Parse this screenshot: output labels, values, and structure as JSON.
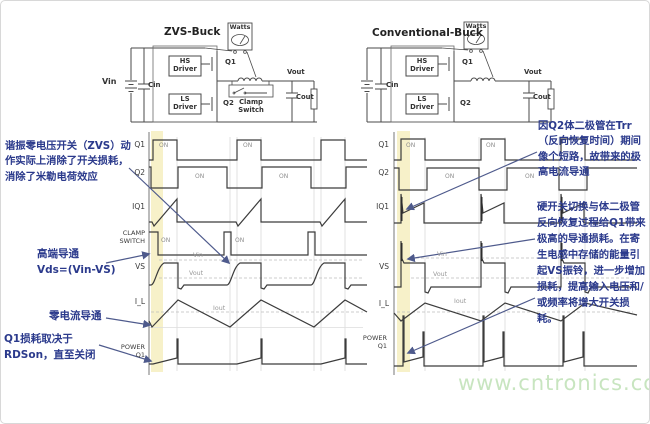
{
  "left_circuit": {
    "title": "ZVS-Buck",
    "watts_label": "Watts",
    "vin_label": "Vin",
    "cin_label": "Cin",
    "hs_driver": "HS\nDriver",
    "ls_driver": "LS\nDriver",
    "q1_label": "Q1",
    "q2_label": "Q2",
    "clamp_label": "Clamp\nSwitch",
    "vout_label": "Vout",
    "cout_label": "Cout"
  },
  "right_circuit": {
    "title": "Conventional-Buck",
    "watts_label": "Watts",
    "cin_label": "Cin",
    "hs_driver": "HS\nDriver",
    "ls_driver": "LS\nDriver",
    "q1_label": "Q1",
    "q2_label": "Q2",
    "vout_label": "Vout",
    "cout_label": "Cout"
  },
  "left_waveforms": {
    "row_labels": {
      "q1": "Q1",
      "q2": "Q2",
      "iq1": "IQ1",
      "clamp": "CLAMP\nSWITCH",
      "vs": "VS",
      "il": "I_L",
      "power": "POWER\nQ1"
    }
  },
  "right_waveforms": {
    "row_labels": {
      "q1": "Q1",
      "q2": "Q2",
      "iq1": "IQ1",
      "vs": "VS",
      "il": "I_L",
      "power": "POWER\nQ1"
    }
  },
  "waveforms_common": {
    "on_label": "ON",
    "vin_level": "Vin",
    "vout_level": "Vout",
    "iout_level": "Iout"
  },
  "annotations": {
    "zvs": "谐振零电压开关（ZVS）动作实际上消除了开关损耗，消除了米勒电荷效应",
    "high_side": "高端导通\nVds=(Vin-VS)",
    "zero_current": "零电流导通",
    "q1_loss": "Q1损耗取决于RDSon，直至关闭",
    "trr": "因Q2体二极管在Trr（反向恢复时间）期间像个短路，故带来的极高电流导通",
    "hard_switching": "硬开关切换与体二极管反向恢复过程给Q1带来极高的导通损耗。在寄生电感中存储的能量引起VS振铃，进一步增加损耗，提高输入电压和/或频率将增大开关损耗。"
  },
  "watermark": "www.cntronics.com",
  "colors": {
    "annotation": "#2b3a8c",
    "arrow": "#4e5a8c",
    "waveform": "#3c3c3c",
    "highlight_band": "#f6f0c3",
    "watermark": "#c8e5c0"
  }
}
